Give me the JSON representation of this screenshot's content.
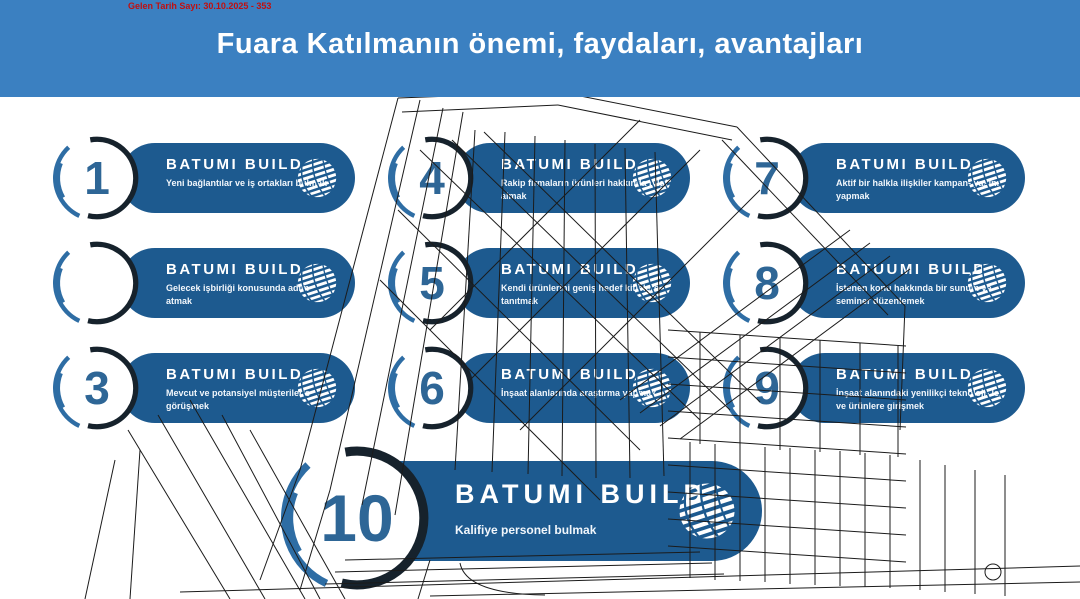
{
  "meta_note": {
    "text": "Gelen Tarih Sayı: 30.10.2025 - 353",
    "color": "#c01010"
  },
  "banner": {
    "title": "Fuara Katılmanın önemi, faydaları, avantajları",
    "bg_color": "#3b80c1"
  },
  "palette": {
    "pill_blue": "#1d5a8f",
    "number_blue": "#2e6696",
    "ring_dark": "#16222c",
    "ring_steel": "#2e6da4",
    "text_white": "#ffffff"
  },
  "icons": {
    "globe": "globe-icon"
  },
  "items": [
    {
      "number": "1",
      "title": "BATUMI BUILD",
      "desc": "Yeni bağlantılar ve iş ortakları bulmak"
    },
    {
      "number": "",
      "title": "BATUMI BUILD",
      "desc": "Gelecek işbirliği konusunda adım atmak"
    },
    {
      "number": "3",
      "title": "BATUMI BUILD",
      "desc": "Mevcut ve potansiyel müşterilerle görüşmek"
    },
    {
      "number": "4",
      "title": "BATUMI BUILD",
      "desc": "Rakip firmaların ürünleri hakkında bilgi almak"
    },
    {
      "number": "5",
      "title": "BATUMI BUILD",
      "desc": "Kendi ürünlerini geniş hedef kitlelere tanıtmak"
    },
    {
      "number": "6",
      "title": "BATUMI BUILD",
      "desc": "İnşaat alanlarında araştırma yapmak"
    },
    {
      "number": "7",
      "title": "BATUMI BUILD",
      "desc": "Aktif bir halkla ilişkiler kampan- yasını yapmak"
    },
    {
      "number": "8",
      "title": "BATUUMI BUILD",
      "desc": "İstenen konu hakkında bir sunum ve seminer düzenlemek"
    },
    {
      "number": "9",
      "title": "BATUMI BUILD",
      "desc": "İnşaat alanındaki yenilikçi teknoloji- ler ve ürünlere girişmek"
    },
    {
      "number": "10",
      "title": "BATUMI BUILD",
      "desc": "Kalifiye personel bulmak"
    }
  ]
}
